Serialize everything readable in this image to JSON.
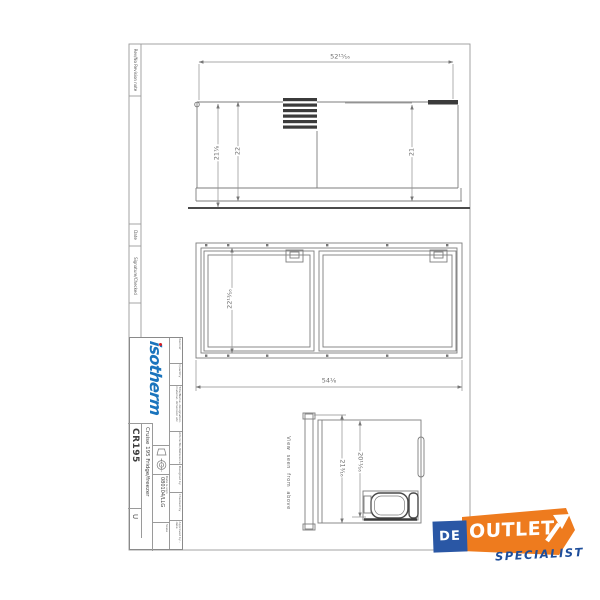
{
  "sheet": {
    "revision_column": {
      "revision_note_label": "Rev/No Revision note",
      "date_label": "Date",
      "signature_label": "Signature/Checked"
    },
    "title_block": {
      "brand_logo_text": "isotherm",
      "field_labels": [
        "Itemref",
        "Quantity",
        "Title/Name, designation, material, dimension etc",
        "Article No./Reference",
        "Designed by",
        "Checked by",
        "Approved by - date"
      ],
      "date_field_label": "Date & sign",
      "date_code": "080104/LLG",
      "scale_label": "Scale",
      "product_title": "Cruise 195 Fridge/freezer",
      "drawing_number": "CR195",
      "revision": "U"
    }
  },
  "views": {
    "top_view": {
      "width_dim": "52¹⁵⁄₁₆",
      "height_left_dim": "21⁷⁄₈",
      "height_mid_dim": "22",
      "height_right_dim": "21"
    },
    "front_view": {
      "height_dim": "22¹³⁄₁₆",
      "width_dim": "54¹⁄₈"
    },
    "side_view": {
      "caption": "View seen from above",
      "depth_total_dim": "21³⁄₁₆",
      "depth_body_dim": "20¹¹⁄₁₆"
    }
  },
  "watermark": {
    "de_text": "DE",
    "outlet_text": "OUTLET",
    "specialist_text": "SPECIALIST",
    "orange": "#EE7B1E",
    "box_blue": "#2A57A5",
    "text_blue": "#1E4E9B"
  },
  "colors": {
    "isotherm_blue": "#1A74BD",
    "isotherm_red": "#D61C22",
    "line_gray": "#8a8a8a"
  }
}
